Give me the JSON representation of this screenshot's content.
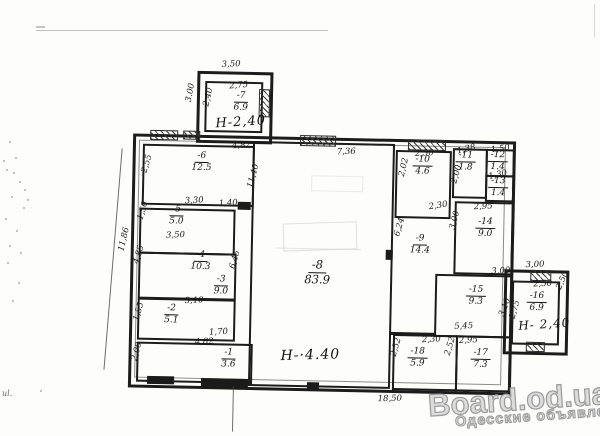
{
  "watermark": {
    "site": "Board.od.ua",
    "tagline": "Одесские объявления"
  },
  "artifact_text": "ul.",
  "colors": {
    "ink": "#1c1c1c",
    "paper": "#fdfdfb",
    "watermark_fill": "#dcdcdc",
    "watermark_outline": "#9b9b9b"
  },
  "plan": {
    "height_labels": [
      {
        "text": "Н-2,40",
        "x": 213,
        "y": 116,
        "size": 13,
        "rot": -5
      },
      {
        "text": "Н-·4.40",
        "x": 283,
        "y": 347,
        "size": 14,
        "rot": -3
      },
      {
        "text": "Н- 2,40",
        "x": 520,
        "y": 312,
        "size": 12,
        "rot": -5
      }
    ],
    "rooms": [
      {
        "num": "-7",
        "area": "6.9",
        "x": 238,
        "y": 92,
        "big": false
      },
      {
        "num": "-6",
        "area": "12.5",
        "x": 200,
        "y": 153,
        "big": false
      },
      {
        "num": "-5",
        "area": "5.0",
        "x": 176,
        "y": 207,
        "big": false
      },
      {
        "num": "-4",
        "area": "10.3",
        "x": 201,
        "y": 252,
        "big": false
      },
      {
        "num": "-3",
        "area": "9.0",
        "x": 222,
        "y": 276,
        "big": false
      },
      {
        "num": "-2",
        "area": "5.1",
        "x": 173,
        "y": 306,
        "big": false
      },
      {
        "num": "-1",
        "area": "3.6",
        "x": 231,
        "y": 349,
        "big": false
      },
      {
        "num": "-8",
        "area": "83.9",
        "x": 318,
        "y": 258,
        "big": true
      },
      {
        "num": "-10",
        "area": "4.6",
        "x": 421,
        "y": 152,
        "big": false
      },
      {
        "num": "-11",
        "area": "1.8",
        "x": 464,
        "y": 147,
        "big": false
      },
      {
        "num": "-12",
        "area": "1.4",
        "x": 496,
        "y": 146,
        "big": false
      },
      {
        "num": "-13",
        "area": "1.4",
        "x": 497,
        "y": 172,
        "big": false
      },
      {
        "num": "-9",
        "area": "14.4",
        "x": 420,
        "y": 231,
        "big": false
      },
      {
        "num": "-14",
        "area": "9.0",
        "x": 485,
        "y": 213,
        "big": false
      },
      {
        "num": "-15",
        "area": "9.3",
        "x": 477,
        "y": 281,
        "big": false
      },
      {
        "num": "-18",
        "area": "5.9",
        "x": 420,
        "y": 344,
        "big": false
      },
      {
        "num": "-17",
        "area": "7.3",
        "x": 483,
        "y": 344,
        "big": false
      },
      {
        "num": "-16",
        "area": "6.9",
        "x": 538,
        "y": 286,
        "big": false
      }
    ],
    "dims": [
      {
        "t": "3,50",
        "x": 218,
        "y": 61,
        "r": -3
      },
      {
        "t": "2,75",
        "x": 226,
        "y": 82,
        "r": -6
      },
      {
        "t": "3.00",
        "x": 178,
        "y": 90,
        "r": -80
      },
      {
        "t": "2,40",
        "x": 196,
        "y": 94,
        "r": -78
      },
      {
        "t": "4,82",
        "x": 230,
        "y": 142,
        "r": -5
      },
      {
        "t": "7,36",
        "x": 335,
        "y": 146,
        "r": -3
      },
      {
        "t": "2,55",
        "x": 136,
        "y": 162,
        "r": -75
      },
      {
        "t": "11,86",
        "x": 112,
        "y": 238,
        "r": -78
      },
      {
        "t": "11,40",
        "x": 240,
        "y": 172,
        "r": -76
      },
      {
        "t": "1,50",
        "x": 133,
        "y": 209,
        "r": -75
      },
      {
        "t": "3,30",
        "x": 184,
        "y": 198,
        "r": -4
      },
      {
        "t": "1,40",
        "x": 218,
        "y": 200,
        "r": -4
      },
      {
        "t": "3,50",
        "x": 166,
        "y": 233,
        "r": -3
      },
      {
        "t": "4,85",
        "x": 130,
        "y": 253,
        "r": -75
      },
      {
        "t": "6,45",
        "x": 226,
        "y": 256,
        "r": -75
      },
      {
        "t": "3,10",
        "x": 186,
        "y": 298,
        "r": -3
      },
      {
        "t": "1,55",
        "x": 131,
        "y": 310,
        "r": -75
      },
      {
        "t": "1,70",
        "x": 211,
        "y": 329,
        "r": -4
      },
      {
        "t": "4,82",
        "x": 197,
        "y": 339,
        "r": -3
      },
      {
        "t": "2,00",
        "x": 130,
        "y": 350,
        "r": -75
      },
      {
        "t": "18,50",
        "x": 381,
        "y": 392,
        "r": -3
      },
      {
        "t": "2,30",
        "x": 413,
        "y": 146,
        "r": -4
      },
      {
        "t": "2,02",
        "x": 393,
        "y": 160,
        "r": -78
      },
      {
        "t": "1,38",
        "x": 455,
        "y": 141,
        "r": -15
      },
      {
        "t": "2,00",
        "x": 446,
        "y": 166,
        "r": -75
      },
      {
        "t": "1,50",
        "x": 489,
        "y": 140,
        "r": -8
      },
      {
        "t": "1,30",
        "x": 487,
        "y": 166,
        "r": -14
      },
      {
        "t": "2,95",
        "x": 473,
        "y": 198,
        "r": -4
      },
      {
        "t": "2,30",
        "x": 428,
        "y": 198,
        "r": -10
      },
      {
        "t": "3,00",
        "x": 445,
        "y": 212,
        "r": -76
      },
      {
        "t": "6,24",
        "x": 390,
        "y": 220,
        "r": -75
      },
      {
        "t": "3,00",
        "x": 492,
        "y": 262,
        "r": -4
      },
      {
        "t": "3,10",
        "x": 497,
        "y": 298,
        "r": -70
      },
      {
        "t": "5,45",
        "x": 456,
        "y": 318,
        "r": -4
      },
      {
        "t": "2,30",
        "x": 424,
        "y": 332,
        "r": -4
      },
      {
        "t": "2,95",
        "x": 461,
        "y": 332,
        "r": -4
      },
      {
        "t": "2,52",
        "x": 389,
        "y": 340,
        "r": -75
      },
      {
        "t": "2,52",
        "x": 443,
        "y": 338,
        "r": -75
      },
      {
        "t": "3,00",
        "x": 526,
        "y": 255,
        "r": -3
      },
      {
        "t": "2,50",
        "x": 534,
        "y": 274,
        "r": -4
      },
      {
        "t": "2,75",
        "x": 507,
        "y": 300,
        "r": -75
      },
      {
        "t": "2,50",
        "x": 554,
        "y": 270,
        "r": -68
      }
    ]
  }
}
